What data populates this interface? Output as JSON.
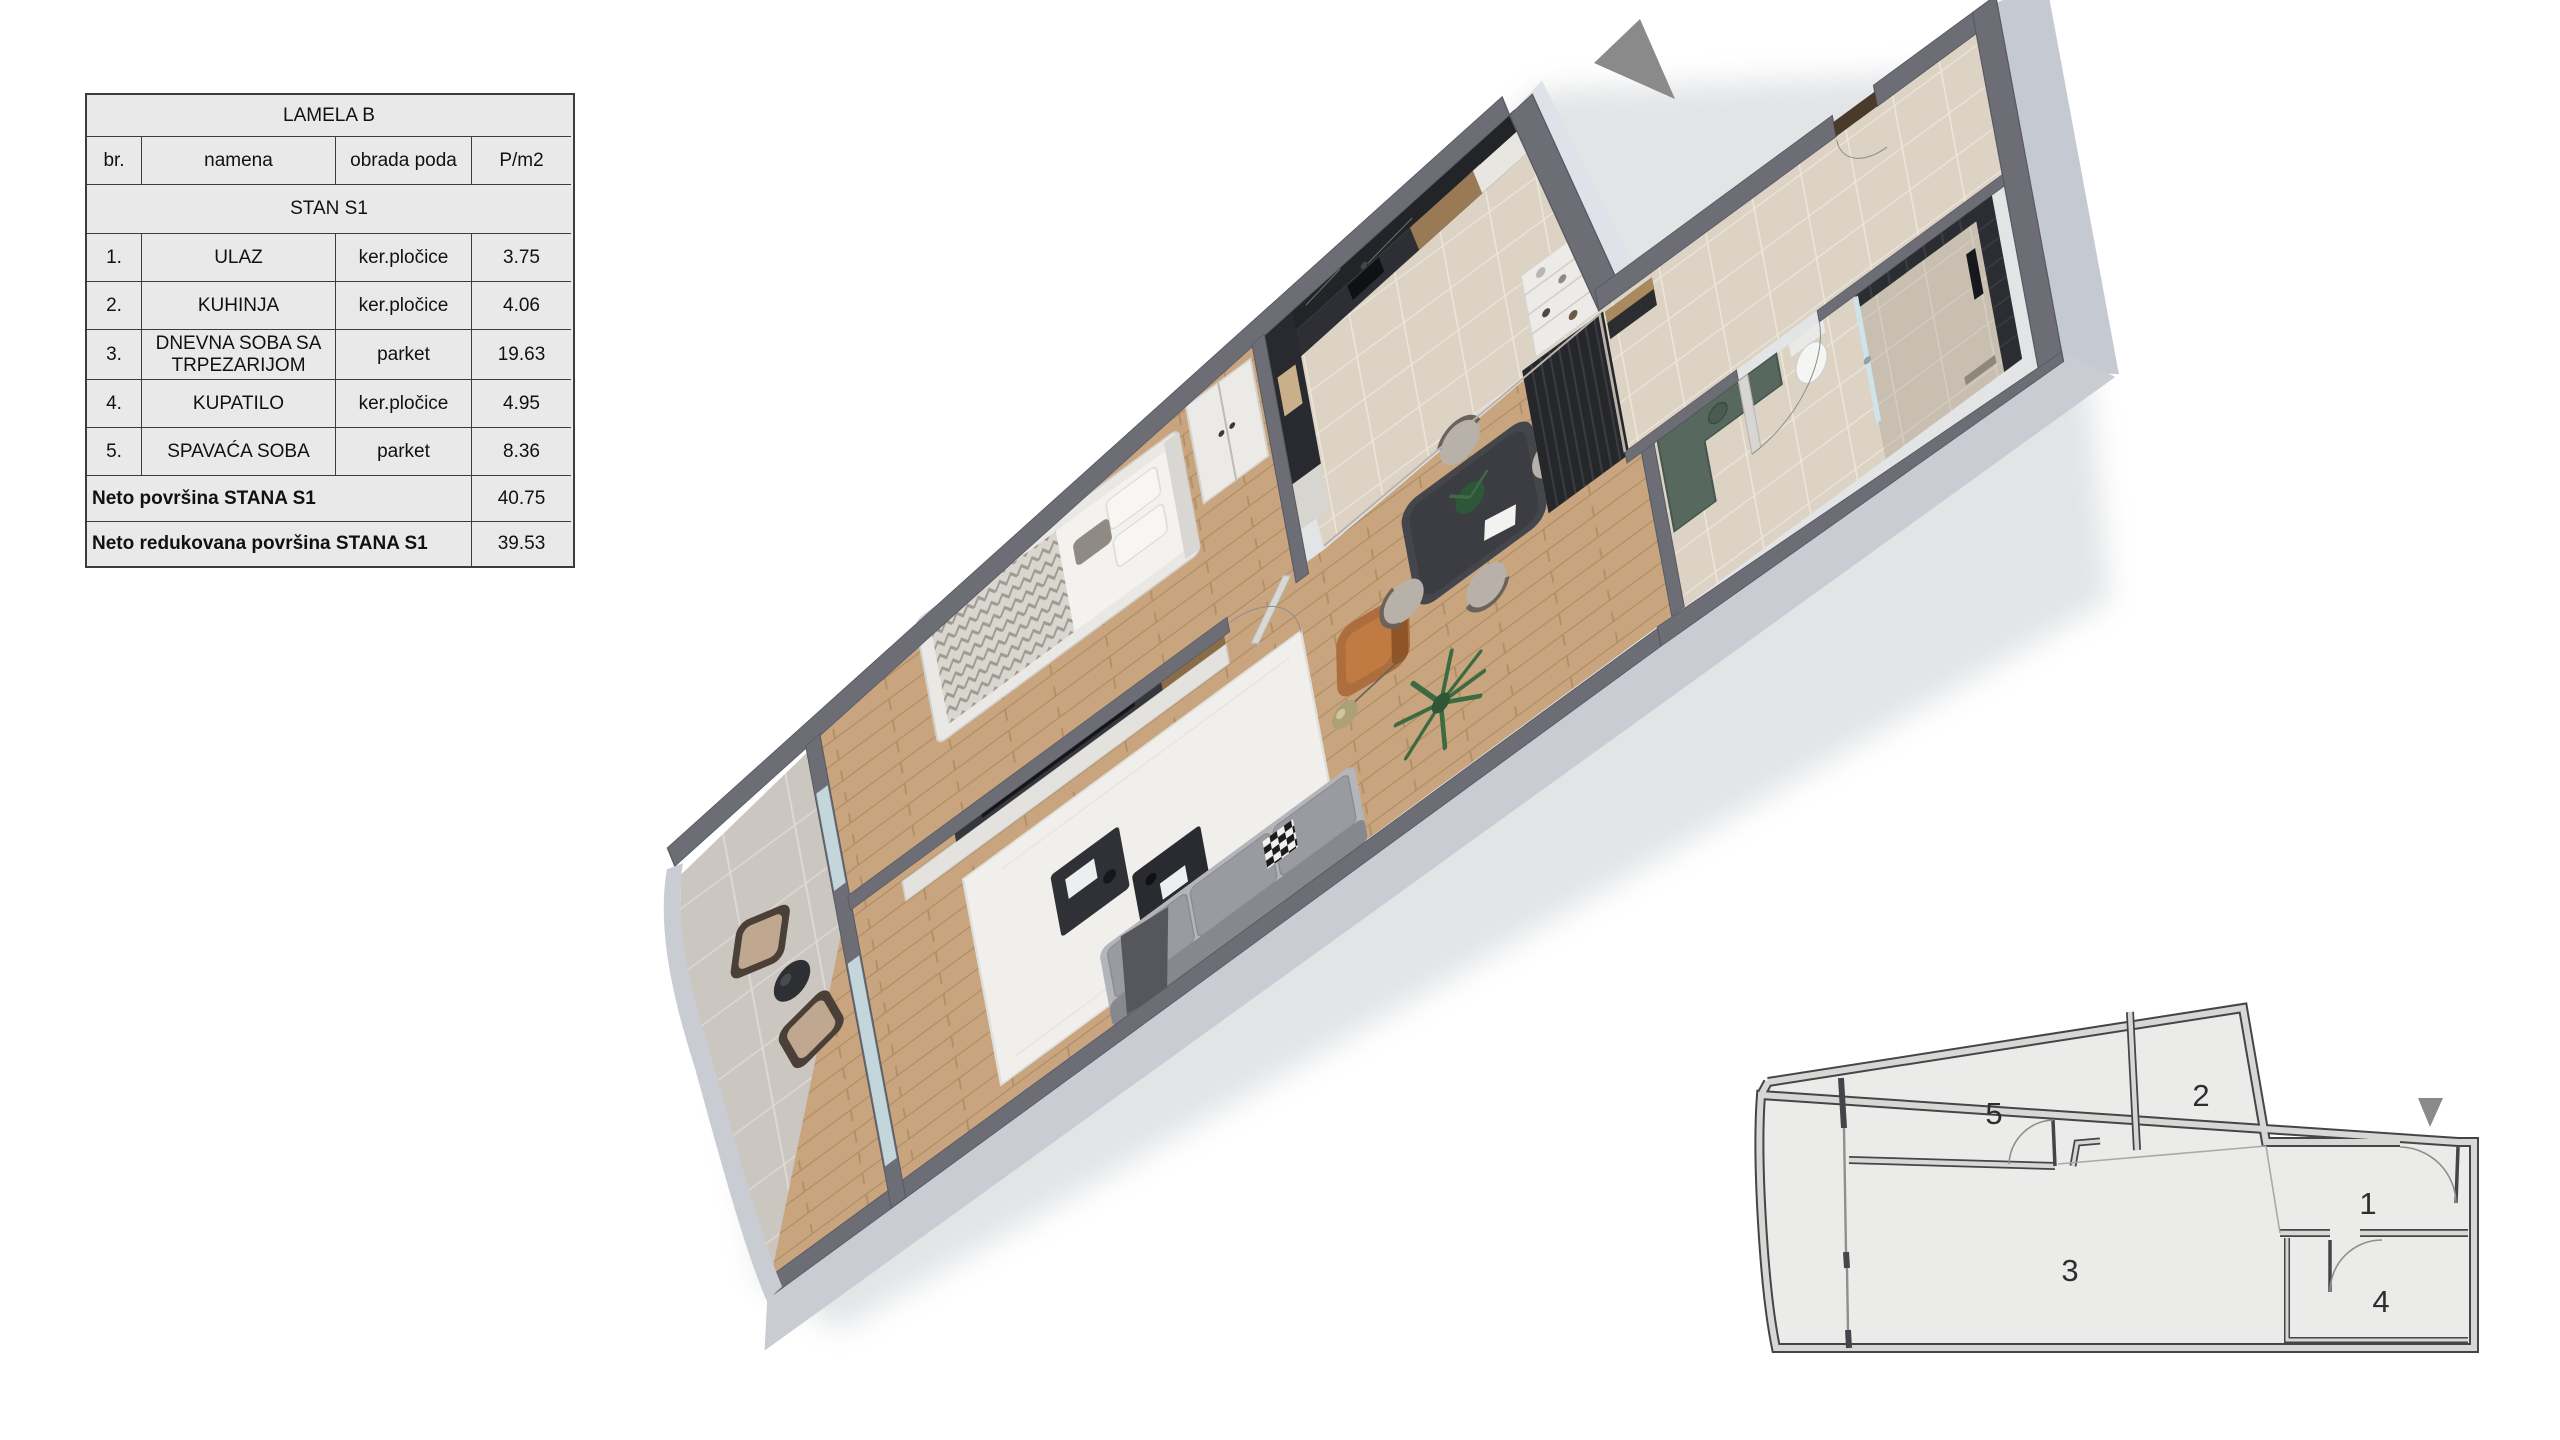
{
  "table": {
    "title": "LAMELA B",
    "columns": {
      "num": "br.",
      "purpose": "namena",
      "floor": "obrada poda",
      "area": "P/m2"
    },
    "section": "STAN  S1",
    "rows": [
      {
        "num": "1.",
        "name": "ULAZ",
        "floor": "ker.pločice",
        "area": "3.75"
      },
      {
        "num": "2.",
        "name": "KUHINJA",
        "floor": "ker.pločice",
        "area": "4.06"
      },
      {
        "num": "3.",
        "name": "DNEVNA SOBA SA TRPEZARIJOM",
        "floor": "parket",
        "area": "19.63"
      },
      {
        "num": "4.",
        "name": "KUPATILO",
        "floor": "ker.pločice",
        "area": "4.95"
      },
      {
        "num": "5.",
        "name": "SPAVAĆA SOBA",
        "floor": "parket",
        "area": "8.36"
      }
    ],
    "totals": [
      {
        "label": "Neto površina STANA S1",
        "value": "40.75"
      },
      {
        "label": "Neto redukovana površina STANA S1",
        "value": "39.53"
      }
    ]
  },
  "plan2d": {
    "rooms": [
      {
        "label": "1"
      },
      {
        "label": "2"
      },
      {
        "label": "3"
      },
      {
        "label": "4"
      },
      {
        "label": "5"
      }
    ],
    "marker_icon": "entrance-triangle-icon"
  },
  "plan3d": {
    "north_arrow_icon": "direction-triangle-icon"
  },
  "colors": {
    "table_bg": "#e9e9e9",
    "table_border": "#3c3c3c",
    "wall_top": "#6c6d75",
    "wall_face_light": "#c5c9d2",
    "parapet": "#c9ccd3",
    "wood_floor": "#c8a57e",
    "kitchen_tile": "#dcd3c5",
    "terrace_tile": "#cbc7c0",
    "bath_tile": "#cdc3b4",
    "marble_dark": "#232428",
    "cabinet_wood": "#997a55",
    "accent_teal": "#57695f",
    "armchair_orange": "#ad6d3c",
    "sofa_gray": "#9a9ba1",
    "closet_black": "#26272b",
    "arrow_gray": "#8a8a8a",
    "plan_line": "#44444a",
    "plan_wall_fill": "#d8d7d4",
    "plan_room_fill": "#ebebe9"
  }
}
